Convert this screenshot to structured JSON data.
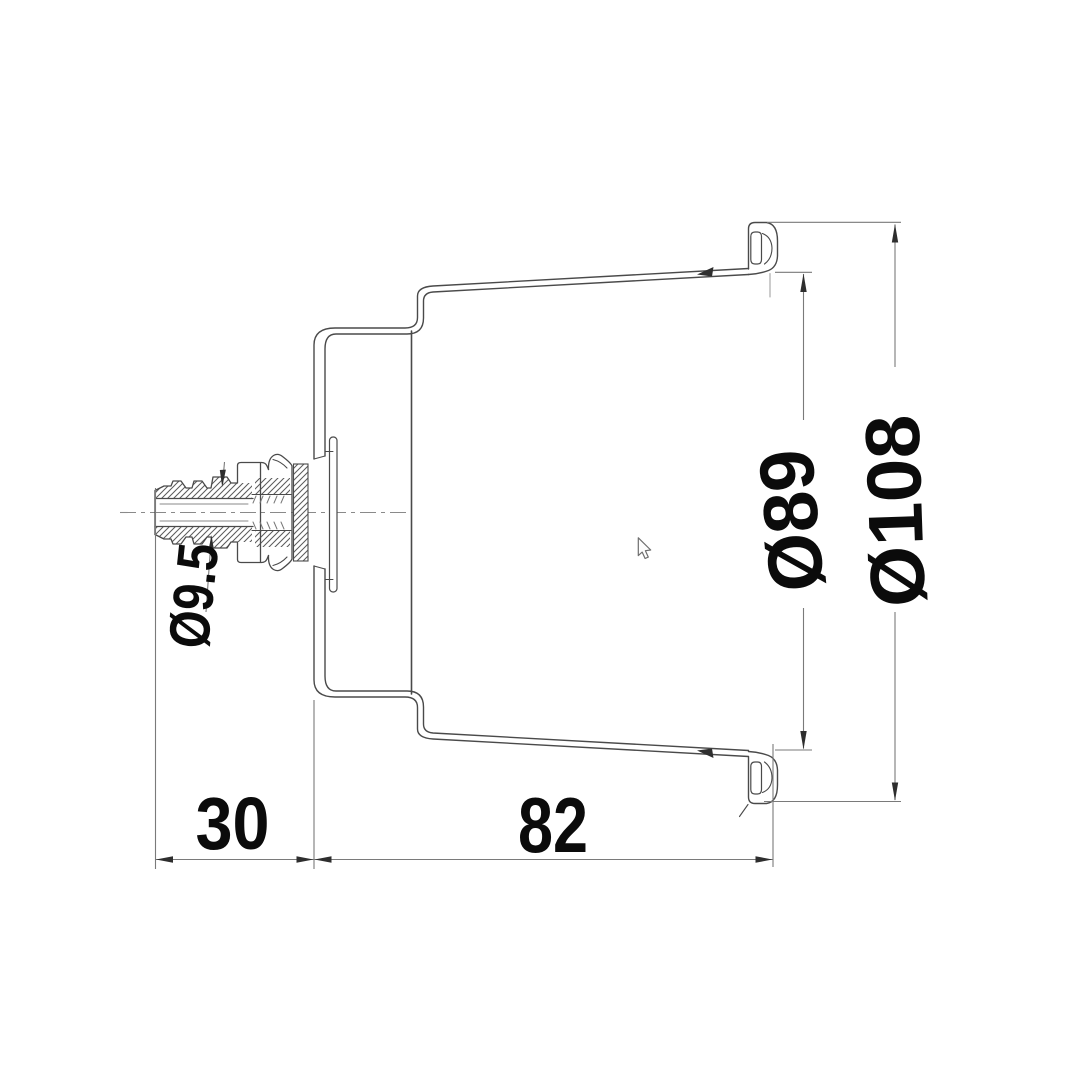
{
  "drawing": {
    "description": "Technical cross-section drawing of a recessed drink holder with drain hose barb",
    "background_color": "#ffffff",
    "line_color": "#4a4a4a",
    "dim_line_color": "#7a7a7a",
    "label_color": "#0b0b0b",
    "dimensions": [
      {
        "id": "drain-barb-diameter",
        "label": "Ø9.5"
      },
      {
        "id": "barb-protrusion-length",
        "label": "30"
      },
      {
        "id": "body-depth",
        "label": "82"
      },
      {
        "id": "inner-diameter",
        "label": "Ø89"
      },
      {
        "id": "outer-flange-diameter",
        "label": "Ø108"
      }
    ],
    "cursor": {
      "visible": true
    }
  }
}
